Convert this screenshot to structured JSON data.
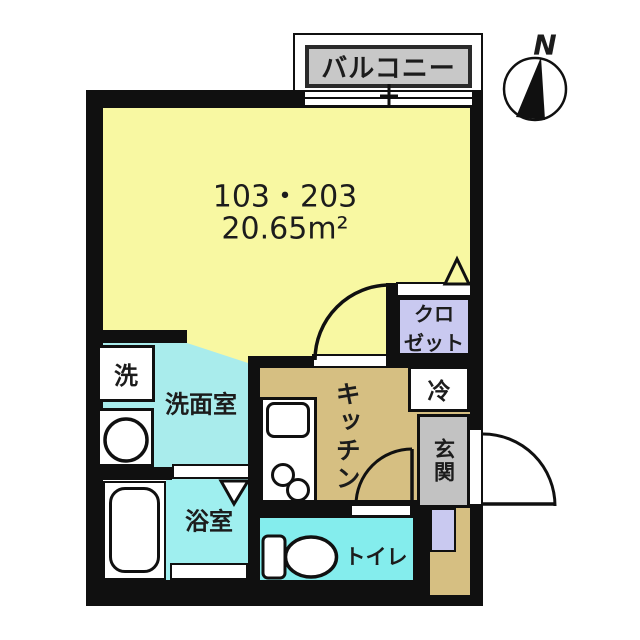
{
  "plan": {
    "balcony": {
      "label": "バルコニー"
    },
    "compass": {
      "label": "N"
    },
    "main_room": {
      "unit_numbers": "103・203",
      "area": "20.65m²"
    },
    "closet": {
      "label_line1": "クロ",
      "label_line2": "ゼット"
    },
    "washroom": {
      "label": "洗面室"
    },
    "washer": {
      "label": "洗"
    },
    "kitchen": {
      "label": "キッチン"
    },
    "fridge": {
      "label": "冷"
    },
    "entrance": {
      "label": "玄関"
    },
    "bathroom": {
      "label": "浴室"
    },
    "toilet": {
      "label": "トイレ"
    },
    "colors": {
      "main_room": "#F8F8A2",
      "washroom": "#A9ECEC",
      "bathroom": "#9FEFEF",
      "toilet": "#84EDED",
      "kitchen": "#D6BF82",
      "closet": "#C9C9F0",
      "entrance_gray": "#C2C2C2",
      "balcony_gray": "#C8C8C8",
      "wall": "#101010"
    }
  }
}
